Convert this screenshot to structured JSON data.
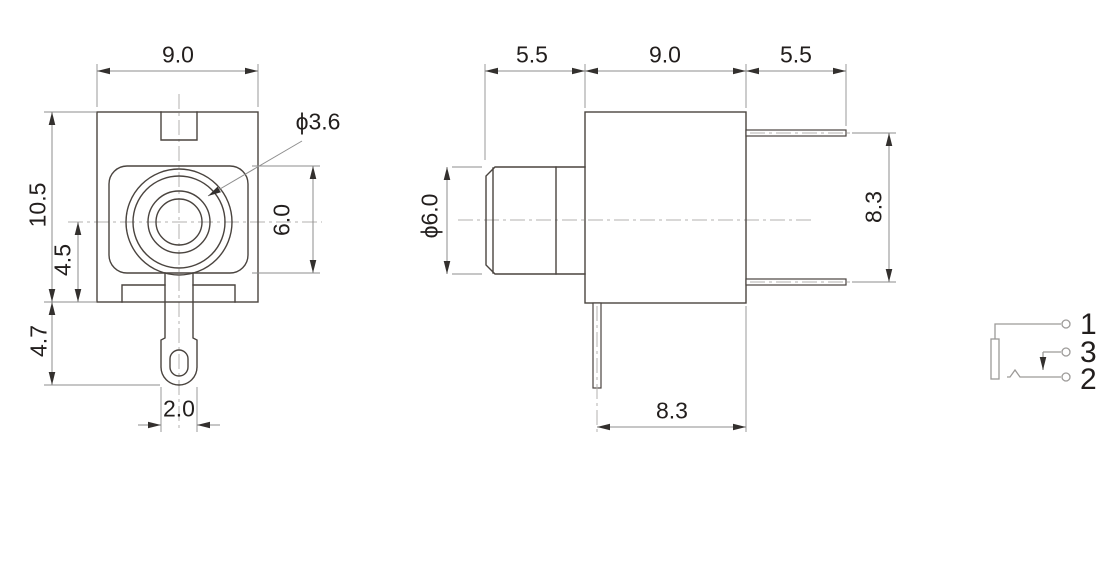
{
  "title": "audio-jack-dimension-drawing",
  "colors": {
    "background": "#ffffff",
    "object_line": "#4a443f",
    "dim_line": "#8e8e8e",
    "center_line": "#b3b1af",
    "arrow": "#33302e",
    "text": "#221e1d",
    "schematic_line": "#9c9a98"
  },
  "front_view": {
    "labels": {
      "body_width": "9.0",
      "body_height": "10.5",
      "center_to_base": "4.5",
      "lug_length": "4.7",
      "lug_width": "2.0",
      "bushing_height": "6.0",
      "hole_diameter": "ϕ3.6"
    }
  },
  "side_view": {
    "labels": {
      "bushing_length": "5.5",
      "body_length": "9.0",
      "pin_length": "5.5",
      "bushing_diameter": "ϕ6.0",
      "pin_span_vertical": "8.3",
      "pin_offset_bottom": "8.3"
    }
  },
  "schematic": {
    "pin_labels": [
      "1",
      "3",
      "2"
    ]
  }
}
